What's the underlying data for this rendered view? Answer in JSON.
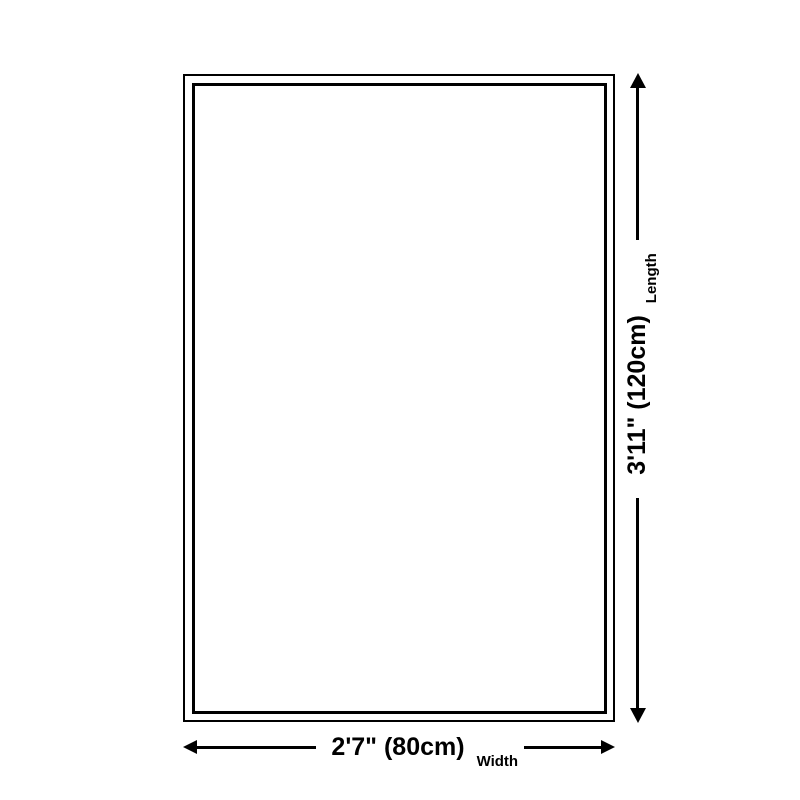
{
  "colors": {
    "background": "#ffffff",
    "line": "#000000",
    "text": "#000000"
  },
  "diagram": {
    "name": "product-size-diagram",
    "length": {
      "value": "3'11\" (120cm)",
      "label": "Length"
    },
    "width": {
      "value": "2'7\" (80cm)",
      "label": "Width"
    }
  }
}
